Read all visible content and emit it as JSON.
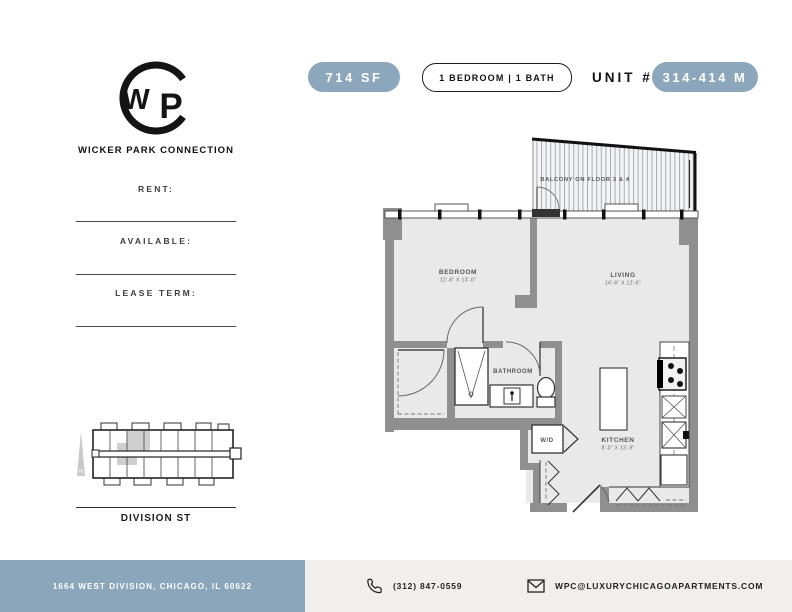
{
  "colors": {
    "accent": "#8ca7bc",
    "footer_address_bg": "#8ba6bb",
    "footer_contact_bg": "#f0efee",
    "wall": "#8f8f8f",
    "floor": "#e9e9e9",
    "highlighted_unit": "#cfcfcf"
  },
  "header": {
    "area_badge": "714 SF",
    "bed_bath_badge": "1 BEDROOM | 1 BATH",
    "unit_label": "UNIT #",
    "unit_number_badge": "314-414 M"
  },
  "brand": {
    "name": "WICKER PARK CONNECTION",
    "monogram_w": "W",
    "monogram_p": "P"
  },
  "lease_fields": {
    "rent_label": "RENT:",
    "available_label": "AVAILABLE:",
    "lease_term_label": "LEASE TERM:"
  },
  "site_map": {
    "street_label": "DIVISION ST",
    "north_label": "N"
  },
  "floor_plan": {
    "balcony_label": "BALCONY ON FLOOR 3 & 4",
    "bedroom": {
      "name": "BEDROOM",
      "dims": "12'-6\" X 13'-0\""
    },
    "living": {
      "name": "LIVING",
      "dims": "14'-6\" X 12'-6\""
    },
    "bathroom": {
      "name": "BATHROOM"
    },
    "kitchen": {
      "name": "KITCHEN",
      "dims": "8'-0\" X 13'-9\""
    },
    "washer_dryer_label": "W/D"
  },
  "footer": {
    "address": "1664 WEST DIVISION, CHICAGO, IL 60622",
    "phone": "(312) 847-0559",
    "email": "WPC@LUXURYCHICAGOAPARTMENTS.COM"
  }
}
